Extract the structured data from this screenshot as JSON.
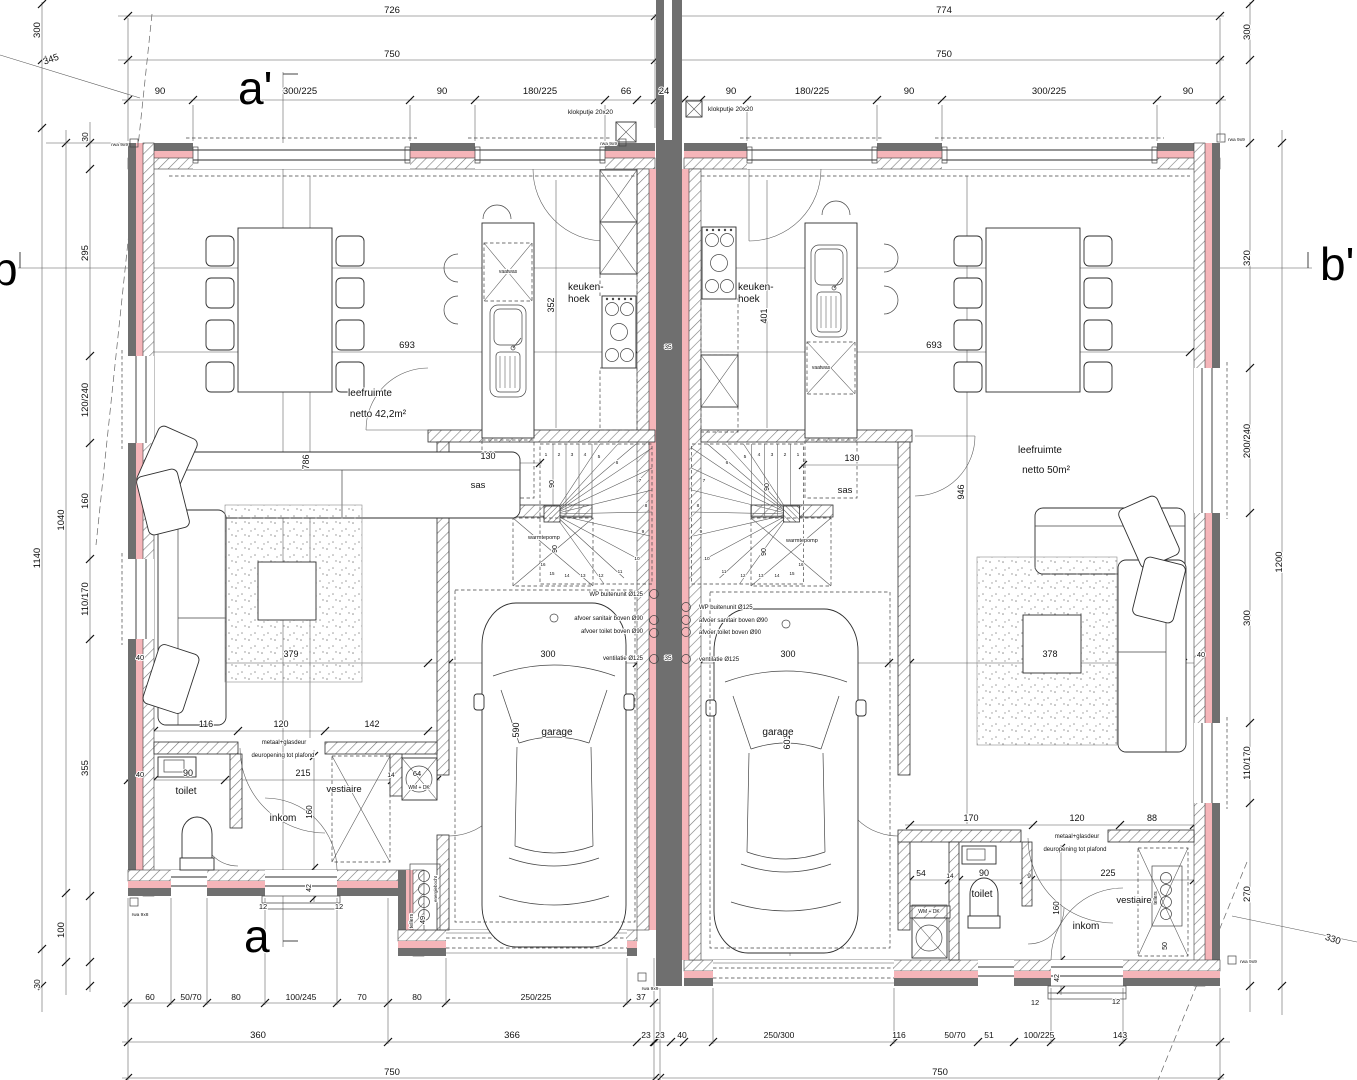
{
  "colors": {
    "wall_gray": "#6f6f6f",
    "insulation_pink": "#f5b5b9",
    "line_dark": "#2e2e2e",
    "dim_line": "#555555"
  },
  "sections": {
    "a_top": "a'",
    "a_bottom": "a",
    "b_left": "b",
    "b_right": "b'"
  },
  "units": {
    "left": {
      "living": "leefruimte",
      "living_area": "netto 42,2m²",
      "kitchen": "keuken-hoek",
      "airlock": "sas",
      "garage": "garage",
      "toilet": "toilet",
      "hall": "inkom",
      "cloakroom": "vestiaire",
      "washer": "WM + DK",
      "heatpump": "warmtepomp",
      "dishwasher": "vaatwas",
      "meters": "tellers"
    },
    "right": {
      "living": "leefruimte",
      "living_area": "netto 50m²",
      "kitchen": "keuken-hoek",
      "airlock": "sas",
      "garage": "garage",
      "toilet": "toilet",
      "hall": "inkom",
      "cloakroom": "vestiaire",
      "washer": "WM + DK",
      "heatpump": "warmtepomp",
      "dishwasher": "vaatwas",
      "meters": "tellers"
    }
  },
  "labels": [
    {
      "t": "726",
      "x": 392,
      "y": 13
    },
    {
      "t": "774",
      "x": 944,
      "y": 13
    },
    {
      "t": "750",
      "x": 392,
      "y": 57
    },
    {
      "t": "750",
      "x": 944,
      "y": 57
    },
    {
      "t": "90",
      "x": 160,
      "y": 94
    },
    {
      "t": "300/225",
      "x": 300,
      "y": 94
    },
    {
      "t": "90",
      "x": 442,
      "y": 94
    },
    {
      "t": "180/225",
      "x": 540,
      "y": 94
    },
    {
      "t": "66",
      "x": 626,
      "y": 94
    },
    {
      "t": "24",
      "x": 664,
      "y": 94
    },
    {
      "t": "90",
      "x": 731,
      "y": 94
    },
    {
      "t": "180/225",
      "x": 812,
      "y": 94
    },
    {
      "t": "90",
      "x": 909,
      "y": 94
    },
    {
      "t": "300/225",
      "x": 1049,
      "y": 94
    },
    {
      "t": "90",
      "x": 1188,
      "y": 94
    },
    {
      "t": "klokputje 20x20",
      "x": 613,
      "y": 114,
      "s": 6.5,
      "a": "e",
      "n": "klokputje-label-left"
    },
    {
      "t": "klokputje 20x20",
      "x": 708,
      "y": 111,
      "s": 6.5,
      "a": "s",
      "n": "klokputje-label-right"
    },
    {
      "t": "300",
      "x": 40,
      "y": 30,
      "v": 1
    },
    {
      "t": "345",
      "x": 52,
      "y": 62,
      "r": -20
    },
    {
      "t": "30",
      "x": 88,
      "y": 137,
      "s": 8.5,
      "v": 1
    },
    {
      "t": "295",
      "x": 88,
      "y": 253,
      "v": 1
    },
    {
      "t": "120/240",
      "x": 88,
      "y": 400,
      "v": 1
    },
    {
      "t": "160",
      "x": 88,
      "y": 501,
      "v": 1
    },
    {
      "t": "110/170",
      "x": 88,
      "y": 599,
      "v": 1
    },
    {
      "t": "355",
      "x": 88,
      "y": 768,
      "v": 1
    },
    {
      "t": "100",
      "x": 64,
      "y": 930,
      "v": 1
    },
    {
      "t": "30",
      "x": 40,
      "y": 984,
      "s": 8.5,
      "v": 1
    },
    {
      "t": "1040",
      "x": 64,
      "y": 520,
      "v": 1
    },
    {
      "t": "1140",
      "x": 40,
      "y": 558,
      "v": 1
    },
    {
      "t": "300",
      "x": 1250,
      "y": 32,
      "v": 1
    },
    {
      "t": "320",
      "x": 1250,
      "y": 258,
      "v": 1
    },
    {
      "t": "200/240",
      "x": 1250,
      "y": 441,
      "v": 1
    },
    {
      "t": "300",
      "x": 1250,
      "y": 618,
      "v": 1
    },
    {
      "t": "110/170",
      "x": 1250,
      "y": 763,
      "v": 1
    },
    {
      "t": "270",
      "x": 1250,
      "y": 894,
      "v": 1
    },
    {
      "t": "1200",
      "x": 1282,
      "y": 562,
      "v": 1
    },
    {
      "t": "330",
      "x": 1332,
      "y": 942,
      "r": 18
    },
    {
      "t": "40",
      "x": 1201,
      "y": 657,
      "s": 7.5
    },
    {
      "t": "leefruimte",
      "x": 370,
      "y": 396,
      "s": 10,
      "n": "room-label-living-left"
    },
    {
      "t": "netto 42,2m²",
      "x": 378,
      "y": 417,
      "s": 10,
      "n": "room-area-living-left"
    },
    {
      "t": "keuken-",
      "x": 568,
      "y": 290,
      "s": 10,
      "a": "s",
      "n": "room-label-kitchen-left"
    },
    {
      "t": "hoek",
      "x": 568,
      "y": 302,
      "s": 10,
      "a": "s"
    },
    {
      "t": "693",
      "x": 407,
      "y": 348
    },
    {
      "t": "352",
      "x": 554,
      "y": 305,
      "s": 9,
      "v": 1
    },
    {
      "t": "786",
      "x": 309,
      "y": 462,
      "s": 9,
      "v": 1
    },
    {
      "t": "vaatwas",
      "x": 508,
      "y": 273,
      "s": 5,
      "n": "dishwasher-label-left"
    },
    {
      "t": "sas",
      "x": 478,
      "y": 488,
      "n": "room-label-sas-left"
    },
    {
      "t": "130",
      "x": 488,
      "y": 459,
      "s": 9
    },
    {
      "t": "379",
      "x": 291,
      "y": 657,
      "s": 9
    },
    {
      "t": "116",
      "x": 206,
      "y": 727,
      "s": 9
    },
    {
      "t": "120",
      "x": 281,
      "y": 727,
      "s": 9
    },
    {
      "t": "142",
      "x": 372,
      "y": 727,
      "s": 9
    },
    {
      "t": "300",
      "x": 548,
      "y": 657,
      "s": 9
    },
    {
      "t": "590",
      "x": 519,
      "y": 730,
      "s": 9,
      "v": 1
    },
    {
      "t": "garage",
      "x": 557,
      "y": 735,
      "s": 10,
      "n": "room-label-garage-left"
    },
    {
      "t": "90",
      "x": 554,
      "y": 484,
      "s": 7,
      "v": 1
    },
    {
      "t": "90",
      "x": 557,
      "y": 549,
      "s": 7,
      "v": 1
    },
    {
      "t": "warmtepomp",
      "x": 528,
      "y": 539,
      "s": 5.5,
      "a": "s",
      "n": "heatpump-label-left"
    },
    {
      "t": "WP buitenunit Ø125",
      "x": 643,
      "y": 596,
      "s": 6,
      "a": "e",
      "n": "annotation-wp-left"
    },
    {
      "t": "afvoer sanitair boven Ø90",
      "x": 643,
      "y": 620,
      "s": 6,
      "a": "e"
    },
    {
      "t": "afvoer toilet boven Ø90",
      "x": 643,
      "y": 633,
      "s": 6,
      "a": "e"
    },
    {
      "t": "ventilatie Ø125",
      "x": 643,
      "y": 660,
      "s": 6,
      "a": "e"
    },
    {
      "t": "40",
      "x": 140,
      "y": 777,
      "s": 7.5
    },
    {
      "t": "90",
      "x": 188,
      "y": 776,
      "s": 9
    },
    {
      "t": "toilet",
      "x": 186,
      "y": 794,
      "s": 10,
      "n": "room-label-toilet-left"
    },
    {
      "t": "215",
      "x": 303,
      "y": 776,
      "s": 9
    },
    {
      "t": "14",
      "x": 391,
      "y": 777,
      "s": 6.5
    },
    {
      "t": "64",
      "x": 417,
      "y": 776,
      "s": 7.5
    },
    {
      "t": "WM + DK",
      "x": 419,
      "y": 789,
      "s": 5,
      "n": "washer-label-left"
    },
    {
      "t": "inkom",
      "x": 283,
      "y": 821,
      "s": 10,
      "n": "room-label-inkom-left"
    },
    {
      "t": "160",
      "x": 312,
      "y": 812,
      "s": 8,
      "v": 1
    },
    {
      "t": "vestiaire",
      "x": 344,
      "y": 792,
      "s": 9.5,
      "n": "room-label-vestiaire-left"
    },
    {
      "t": "metaal+glasdeur",
      "x": 284,
      "y": 744,
      "s": 6
    },
    {
      "t": "deuropening tot plafond",
      "x": 283,
      "y": 757,
      "s": 6
    },
    {
      "t": "42",
      "x": 311,
      "y": 888,
      "s": 7,
      "v": 1
    },
    {
      "t": "12",
      "x": 263,
      "y": 909,
      "s": 7.5
    },
    {
      "t": "12",
      "x": 339,
      "y": 909,
      "s": 7.5
    },
    {
      "t": "tellers",
      "x": 413,
      "y": 921,
      "s": 5.5,
      "v": 1,
      "n": "meters-label-left"
    },
    {
      "t": "49",
      "x": 425,
      "y": 920,
      "s": 7.5,
      "v": 1
    },
    {
      "t": "energiebocht",
      "x": 437,
      "y": 889,
      "s": 4.5,
      "v": 1
    },
    {
      "t": "35",
      "x": 668,
      "y": 349,
      "s": 6.5
    },
    {
      "t": "35",
      "x": 668,
      "y": 660,
      "s": 6.5
    },
    {
      "t": "40",
      "x": 140,
      "y": 660,
      "s": 7.5
    },
    {
      "t": "60",
      "x": 150,
      "y": 1000,
      "s": 8.5
    },
    {
      "t": "50/70",
      "x": 191,
      "y": 1000,
      "s": 8.5
    },
    {
      "t": "80",
      "x": 236,
      "y": 1000,
      "s": 8.5
    },
    {
      "t": "100/245",
      "x": 301,
      "y": 1000,
      "s": 8.5
    },
    {
      "t": "70",
      "x": 362,
      "y": 1000,
      "s": 8.5
    },
    {
      "t": "80",
      "x": 417,
      "y": 1000,
      "s": 8.5
    },
    {
      "t": "250/225",
      "x": 536,
      "y": 1000,
      "s": 8.5
    },
    {
      "t": "37",
      "x": 641,
      "y": 1000,
      "s": 8.5
    },
    {
      "t": "360",
      "x": 258,
      "y": 1038
    },
    {
      "t": "366",
      "x": 512,
      "y": 1038
    },
    {
      "t": "23",
      "x": 646,
      "y": 1038,
      "s": 8.5
    },
    {
      "t": "750",
      "x": 392,
      "y": 1075
    },
    {
      "t": "leefruimte",
      "x": 1040,
      "y": 453,
      "s": 10,
      "n": "room-label-living-right"
    },
    {
      "t": "netto 50m²",
      "x": 1046,
      "y": 473,
      "s": 10,
      "n": "room-area-living-right"
    },
    {
      "t": "keuken-",
      "x": 738,
      "y": 290,
      "s": 10,
      "a": "s",
      "n": "room-label-kitchen-right"
    },
    {
      "t": "hoek",
      "x": 738,
      "y": 302,
      "s": 10,
      "a": "s"
    },
    {
      "t": "693",
      "x": 934,
      "y": 348
    },
    {
      "t": "401",
      "x": 767,
      "y": 316,
      "s": 9,
      "v": 1
    },
    {
      "t": "946",
      "x": 964,
      "y": 492,
      "s": 9,
      "v": 1
    },
    {
      "t": "sas",
      "x": 845,
      "y": 493,
      "n": "room-label-sas-right"
    },
    {
      "t": "130",
      "x": 852,
      "y": 461,
      "s": 9
    },
    {
      "t": "378",
      "x": 1050,
      "y": 657,
      "s": 9
    },
    {
      "t": "300",
      "x": 788,
      "y": 657,
      "s": 9
    },
    {
      "t": "601",
      "x": 790,
      "y": 742,
      "s": 9,
      "v": 1
    },
    {
      "t": "garage",
      "x": 778,
      "y": 735,
      "s": 10,
      "n": "room-label-garage-right"
    },
    {
      "t": "90",
      "x": 769,
      "y": 487,
      "s": 7,
      "v": 1
    },
    {
      "t": "90",
      "x": 766,
      "y": 552,
      "s": 7,
      "v": 1
    },
    {
      "t": "warmtepomp",
      "x": 786,
      "y": 542,
      "s": 5.5,
      "a": "s",
      "n": "heatpump-label-right"
    },
    {
      "t": "WP buitenunit Ø125",
      "x": 699,
      "y": 609,
      "s": 6,
      "a": "s",
      "n": "annotation-wp-right"
    },
    {
      "t": "afvoer sanitair boven Ø90",
      "x": 699,
      "y": 622,
      "s": 6,
      "a": "s"
    },
    {
      "t": "afvoer toilet boven Ø90",
      "x": 699,
      "y": 634,
      "s": 6,
      "a": "s"
    },
    {
      "t": "ventilatie Ø125",
      "x": 699,
      "y": 661,
      "s": 6,
      "a": "s"
    },
    {
      "t": "vaatwas",
      "x": 821,
      "y": 369,
      "s": 5,
      "n": "dishwasher-label-right"
    },
    {
      "t": "170",
      "x": 971,
      "y": 821,
      "s": 9
    },
    {
      "t": "120",
      "x": 1077,
      "y": 821,
      "s": 9
    },
    {
      "t": "88",
      "x": 1152,
      "y": 821,
      "s": 9
    },
    {
      "t": "metaal+glasdeur",
      "x": 1077,
      "y": 838,
      "s": 6
    },
    {
      "t": "deuropening tot plafond",
      "x": 1075,
      "y": 851,
      "s": 6
    },
    {
      "t": "54",
      "x": 921,
      "y": 876,
      "s": 8.5
    },
    {
      "t": "14",
      "x": 950,
      "y": 878,
      "s": 6.5
    },
    {
      "t": "90",
      "x": 984,
      "y": 876,
      "s": 9
    },
    {
      "t": "9",
      "x": 1029,
      "y": 878,
      "s": 6.5
    },
    {
      "t": "225",
      "x": 1108,
      "y": 876,
      "s": 9
    },
    {
      "t": "toilet",
      "x": 982,
      "y": 897,
      "s": 10,
      "n": "room-label-toilet-right"
    },
    {
      "t": "WM + DK",
      "x": 929,
      "y": 913,
      "s": 5,
      "n": "washer-label-right"
    },
    {
      "t": "inkom",
      "x": 1086,
      "y": 929,
      "s": 10,
      "n": "room-label-inkom-right"
    },
    {
      "t": "160",
      "x": 1059,
      "y": 908,
      "s": 8,
      "v": 1
    },
    {
      "t": "vestiaire",
      "x": 1134,
      "y": 903,
      "s": 9.5,
      "n": "room-label-vestiaire-right"
    },
    {
      "t": "50",
      "x": 1167,
      "y": 946,
      "s": 7,
      "v": 1
    },
    {
      "t": "tellers",
      "x": 1157,
      "y": 898,
      "s": 5,
      "v": 1,
      "n": "meters-label-right"
    },
    {
      "t": "42",
      "x": 1059,
      "y": 978,
      "s": 7,
      "v": 1
    },
    {
      "t": "12",
      "x": 1035,
      "y": 1005,
      "s": 7.5
    },
    {
      "t": "12",
      "x": 1116,
      "y": 1004,
      "s": 7.5
    },
    {
      "t": "23",
      "x": 660,
      "y": 1038,
      "s": 8.5
    },
    {
      "t": "40",
      "x": 682,
      "y": 1038,
      "s": 8.5
    },
    {
      "t": "250/300",
      "x": 779,
      "y": 1038,
      "s": 8.5
    },
    {
      "t": "116",
      "x": 899,
      "y": 1038,
      "s": 8.5
    },
    {
      "t": "50/70",
      "x": 955,
      "y": 1038,
      "s": 8.5
    },
    {
      "t": "51",
      "x": 989,
      "y": 1038,
      "s": 8.5
    },
    {
      "t": "100/225",
      "x": 1039,
      "y": 1038,
      "s": 8.5
    },
    {
      "t": "143",
      "x": 1120,
      "y": 1038,
      "s": 8.5
    },
    {
      "t": "750",
      "x": 940,
      "y": 1075
    },
    {
      "t": "rwa 9x9",
      "x": 128,
      "y": 146,
      "s": 4.8,
      "a": "e",
      "n": "rwa-label"
    },
    {
      "t": "rwa 9x9",
      "x": 617,
      "y": 145,
      "s": 4.8,
      "a": "e",
      "n": "rwa-label"
    },
    {
      "t": "rwa 9x9",
      "x": 1228,
      "y": 141,
      "s": 4.8,
      "a": "s",
      "n": "rwa-label"
    },
    {
      "t": "rwa 9x8",
      "x": 140,
      "y": 916,
      "s": 4.8,
      "n": "rwa-label"
    },
    {
      "t": "rwa 9x9",
      "x": 650,
      "y": 990,
      "s": 4.8,
      "n": "rwa-label"
    },
    {
      "t": "rwa 9x9",
      "x": 1240,
      "y": 963,
      "s": 4.8,
      "a": "s",
      "n": "rwa-label"
    },
    {
      "t": "1",
      "x": 546,
      "y": 456,
      "s": 4.8,
      "n": "stair-tread-number"
    },
    {
      "t": "2",
      "x": 559,
      "y": 456,
      "s": 4.8,
      "n": "stair-tread-number"
    },
    {
      "t": "3",
      "x": 572,
      "y": 456,
      "s": 4.8,
      "n": "stair-tread-number"
    },
    {
      "t": "4",
      "x": 585,
      "y": 456,
      "s": 4.8,
      "n": "stair-tread-number"
    },
    {
      "t": "5",
      "x": 599,
      "y": 458,
      "s": 4.8,
      "n": "stair-tread-number"
    },
    {
      "t": "6",
      "x": 617,
      "y": 464,
      "s": 4.8,
      "n": "stair-tread-number"
    },
    {
      "t": "7",
      "x": 640,
      "y": 482,
      "s": 4.8,
      "n": "stair-tread-number"
    },
    {
      "t": "8",
      "x": 646,
      "y": 507,
      "s": 4.8,
      "n": "stair-tread-number"
    },
    {
      "t": "9",
      "x": 643,
      "y": 533,
      "s": 4.8,
      "n": "stair-tread-number"
    },
    {
      "t": "10",
      "x": 637,
      "y": 560,
      "s": 4.8,
      "n": "stair-tread-number"
    },
    {
      "t": "11",
      "x": 620,
      "y": 573,
      "s": 4.5,
      "n": "stair-tread-number"
    },
    {
      "t": "12",
      "x": 601,
      "y": 577,
      "s": 4.5,
      "n": "stair-tread-number"
    },
    {
      "t": "13",
      "x": 583,
      "y": 577,
      "s": 4.5,
      "n": "stair-tread-number"
    },
    {
      "t": "14",
      "x": 567,
      "y": 577,
      "s": 4.5,
      "n": "stair-tread-number"
    },
    {
      "t": "15",
      "x": 552,
      "y": 575,
      "s": 4.5,
      "n": "stair-tread-number"
    },
    {
      "t": "16",
      "x": 543,
      "y": 566,
      "s": 4.5,
      "n": "stair-tread-number"
    },
    {
      "t": "1",
      "x": 798,
      "y": 456,
      "s": 4.8,
      "n": "stair-tread-number"
    },
    {
      "t": "2",
      "x": 785,
      "y": 456,
      "s": 4.8,
      "n": "stair-tread-number"
    },
    {
      "t": "3",
      "x": 772,
      "y": 456,
      "s": 4.8,
      "n": "stair-tread-number"
    },
    {
      "t": "4",
      "x": 759,
      "y": 456,
      "s": 4.8,
      "n": "stair-tread-number"
    },
    {
      "t": "5",
      "x": 745,
      "y": 458,
      "s": 4.8,
      "n": "stair-tread-number"
    },
    {
      "t": "6",
      "x": 727,
      "y": 464,
      "s": 4.8,
      "n": "stair-tread-number"
    },
    {
      "t": "7",
      "x": 704,
      "y": 482,
      "s": 4.8,
      "n": "stair-tread-number"
    },
    {
      "t": "8",
      "x": 698,
      "y": 507,
      "s": 4.8,
      "n": "stair-tread-number"
    },
    {
      "t": "9",
      "x": 701,
      "y": 533,
      "s": 4.8,
      "n": "stair-tread-number"
    },
    {
      "t": "10",
      "x": 707,
      "y": 560,
      "s": 4.8,
      "n": "stair-tread-number"
    },
    {
      "t": "11",
      "x": 724,
      "y": 573,
      "s": 4.5,
      "n": "stair-tread-number"
    },
    {
      "t": "12",
      "x": 743,
      "y": 577,
      "s": 4.5,
      "n": "stair-tread-number"
    },
    {
      "t": "13",
      "x": 761,
      "y": 577,
      "s": 4.5,
      "n": "stair-tread-number"
    },
    {
      "t": "14",
      "x": 777,
      "y": 577,
      "s": 4.5,
      "n": "stair-tread-number"
    },
    {
      "t": "15",
      "x": 792,
      "y": 575,
      "s": 4.5,
      "n": "stair-tread-number"
    },
    {
      "t": "16",
      "x": 801,
      "y": 566,
      "s": 4.5,
      "n": "stair-tread-number"
    }
  ]
}
